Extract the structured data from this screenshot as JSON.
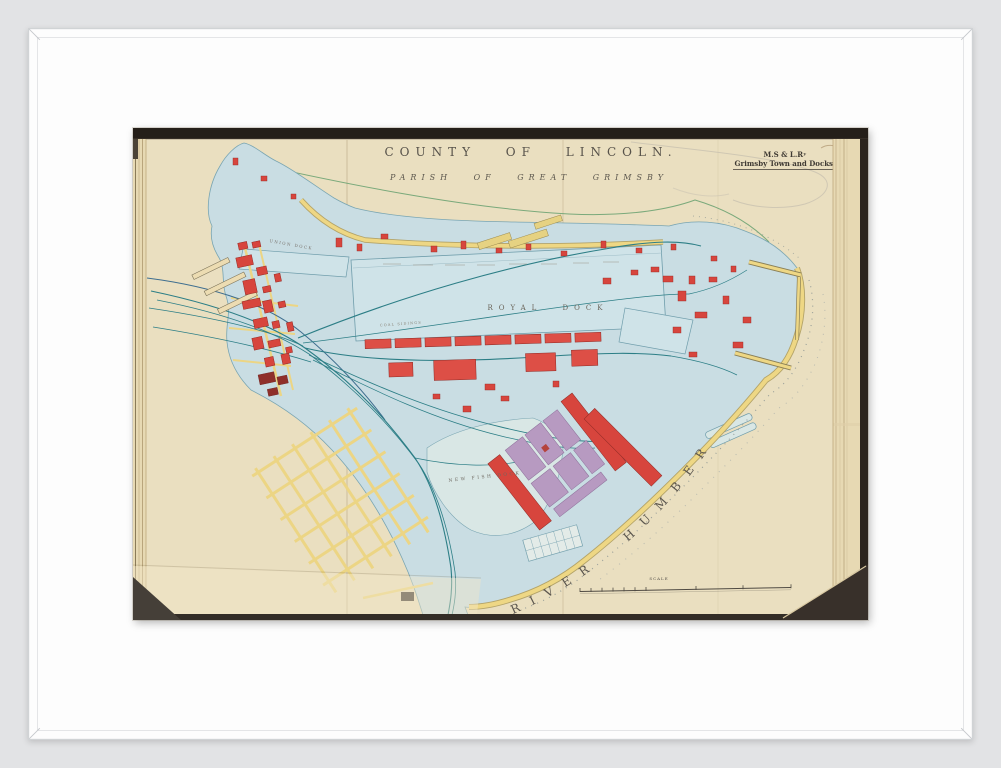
{
  "artwork": {
    "map": {
      "title": "COUNTY OF LINCOLN.",
      "subtitle": "PARISH OF GREAT GRIMSBY",
      "corner_label": {
        "line1": "M.S & L.Rʸ",
        "line2": "Grimsby Town and Docks."
      },
      "labels": {
        "royal_dock": "ROYAL DOCK",
        "union_dock": "UNION DOCK",
        "new_fish_dock": "NEW FISH DOCK",
        "coal_sidings": "COAL SIDINGS",
        "river_humber": "RIVER HUMBER",
        "scale": "SCALE"
      },
      "colors": {
        "water_blue": "#c9dde3",
        "water_outline": "#79a5b2",
        "dock_water": "#cfe3e8",
        "pale_dock_water": "#d9e7e5",
        "page_cream": "#eadfc0",
        "road_yellow": "#eed784",
        "building_red": "#d7453d",
        "building_maroon": "#8f2f2a",
        "building_purple": "#b79ac1",
        "railway_teal": "#2c7e86",
        "boundary_green": "#66a06e",
        "ink_grey": "#55504a"
      }
    },
    "presentation": {
      "background": "#e2e3e5",
      "frame": "#fdfdfd",
      "mat": "#ffffff",
      "book_cover": "#251f19",
      "table": "#332d27"
    }
  }
}
